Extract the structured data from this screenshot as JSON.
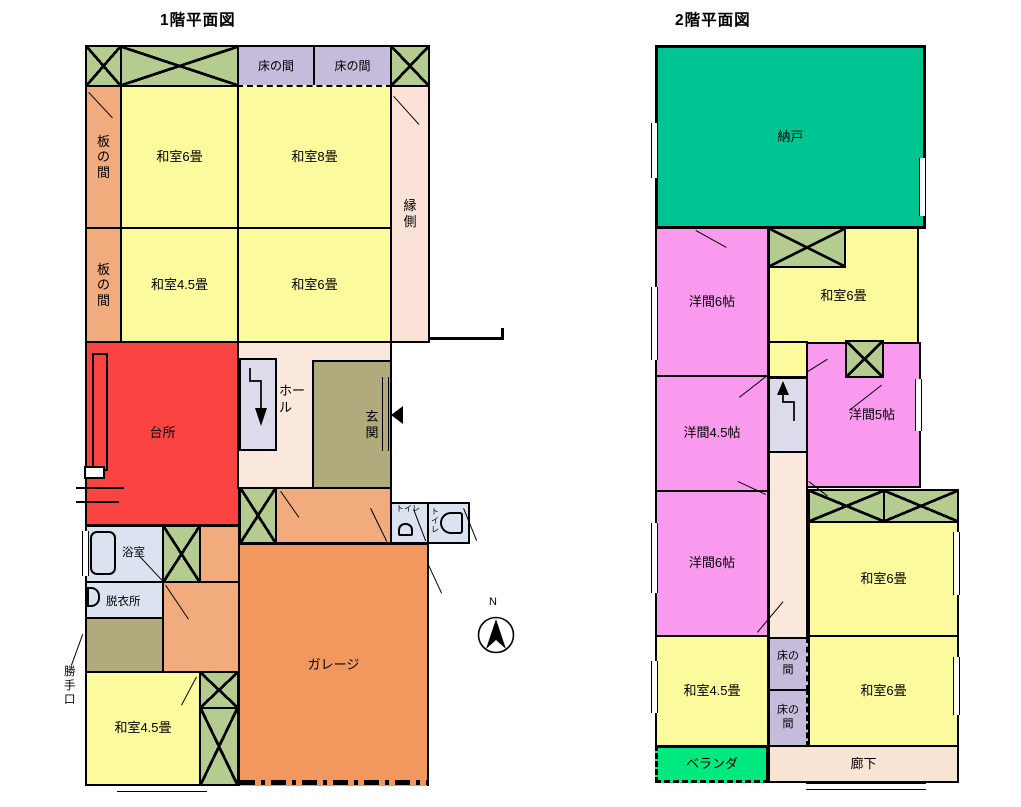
{
  "palette": {
    "tatami_yellow": "#FBFA9D",
    "closet_green": "#B5CC91",
    "tokonoma_purple": "#C5BCDC",
    "wood_orange": "#F2AB7C",
    "engawa_peach": "#FAE3D6",
    "kitchen_red": "#FB4442",
    "hall_cream": "#FAE8DC",
    "genkan_olive": "#B1AA7D",
    "stair_lavender": "#DBDBEC",
    "bath_blue": "#DBE3F0",
    "garage_orange": "#F2985E",
    "western_pink": "#FA9AEF",
    "nando_green": "#00C491",
    "veranda_green": "#00E97E",
    "rouka_cream": "#F8E4D2"
  },
  "floor1": {
    "title": "1階平面図",
    "rooms": {
      "tokonoma_a": "床の間",
      "tokonoma_b": "床の間",
      "itanoma_a": "板の間",
      "itanoma_b": "板の間",
      "washitsu6_a": "和室6畳",
      "washitsu8": "和室8畳",
      "engawa": "縁側",
      "washitsu45_a": "和室4.5畳",
      "washitsu6_b": "和室6畳",
      "daidokoro": "台所",
      "hall": "ホール",
      "genkan": "玄関",
      "yokushitsu": "浴室",
      "datsuiba": "脱衣所",
      "katteguchi": "勝手口",
      "washitsu45_b": "和室4.5畳",
      "garage": "ガレージ",
      "toilet_a": "トイレ",
      "toilet_b": "トイレ"
    }
  },
  "floor2": {
    "title": "2階平面図",
    "rooms": {
      "nando": "納戸",
      "yoma6_a": "洋間6帖",
      "washitsu6_a": "和室6畳",
      "yoma45": "洋間4.5帖",
      "yoma5": "洋間5帖",
      "yoma6_b": "洋間6帖",
      "washitsu6_b": "和室6畳",
      "washitsu45": "和室4.5畳",
      "tokonoma_a": "床の間",
      "tokonoma_b": "床の間",
      "washitsu6_c": "和室6畳",
      "veranda": "ベランダ",
      "rouka": "廊下"
    }
  },
  "compass": {
    "north_label": "N"
  }
}
